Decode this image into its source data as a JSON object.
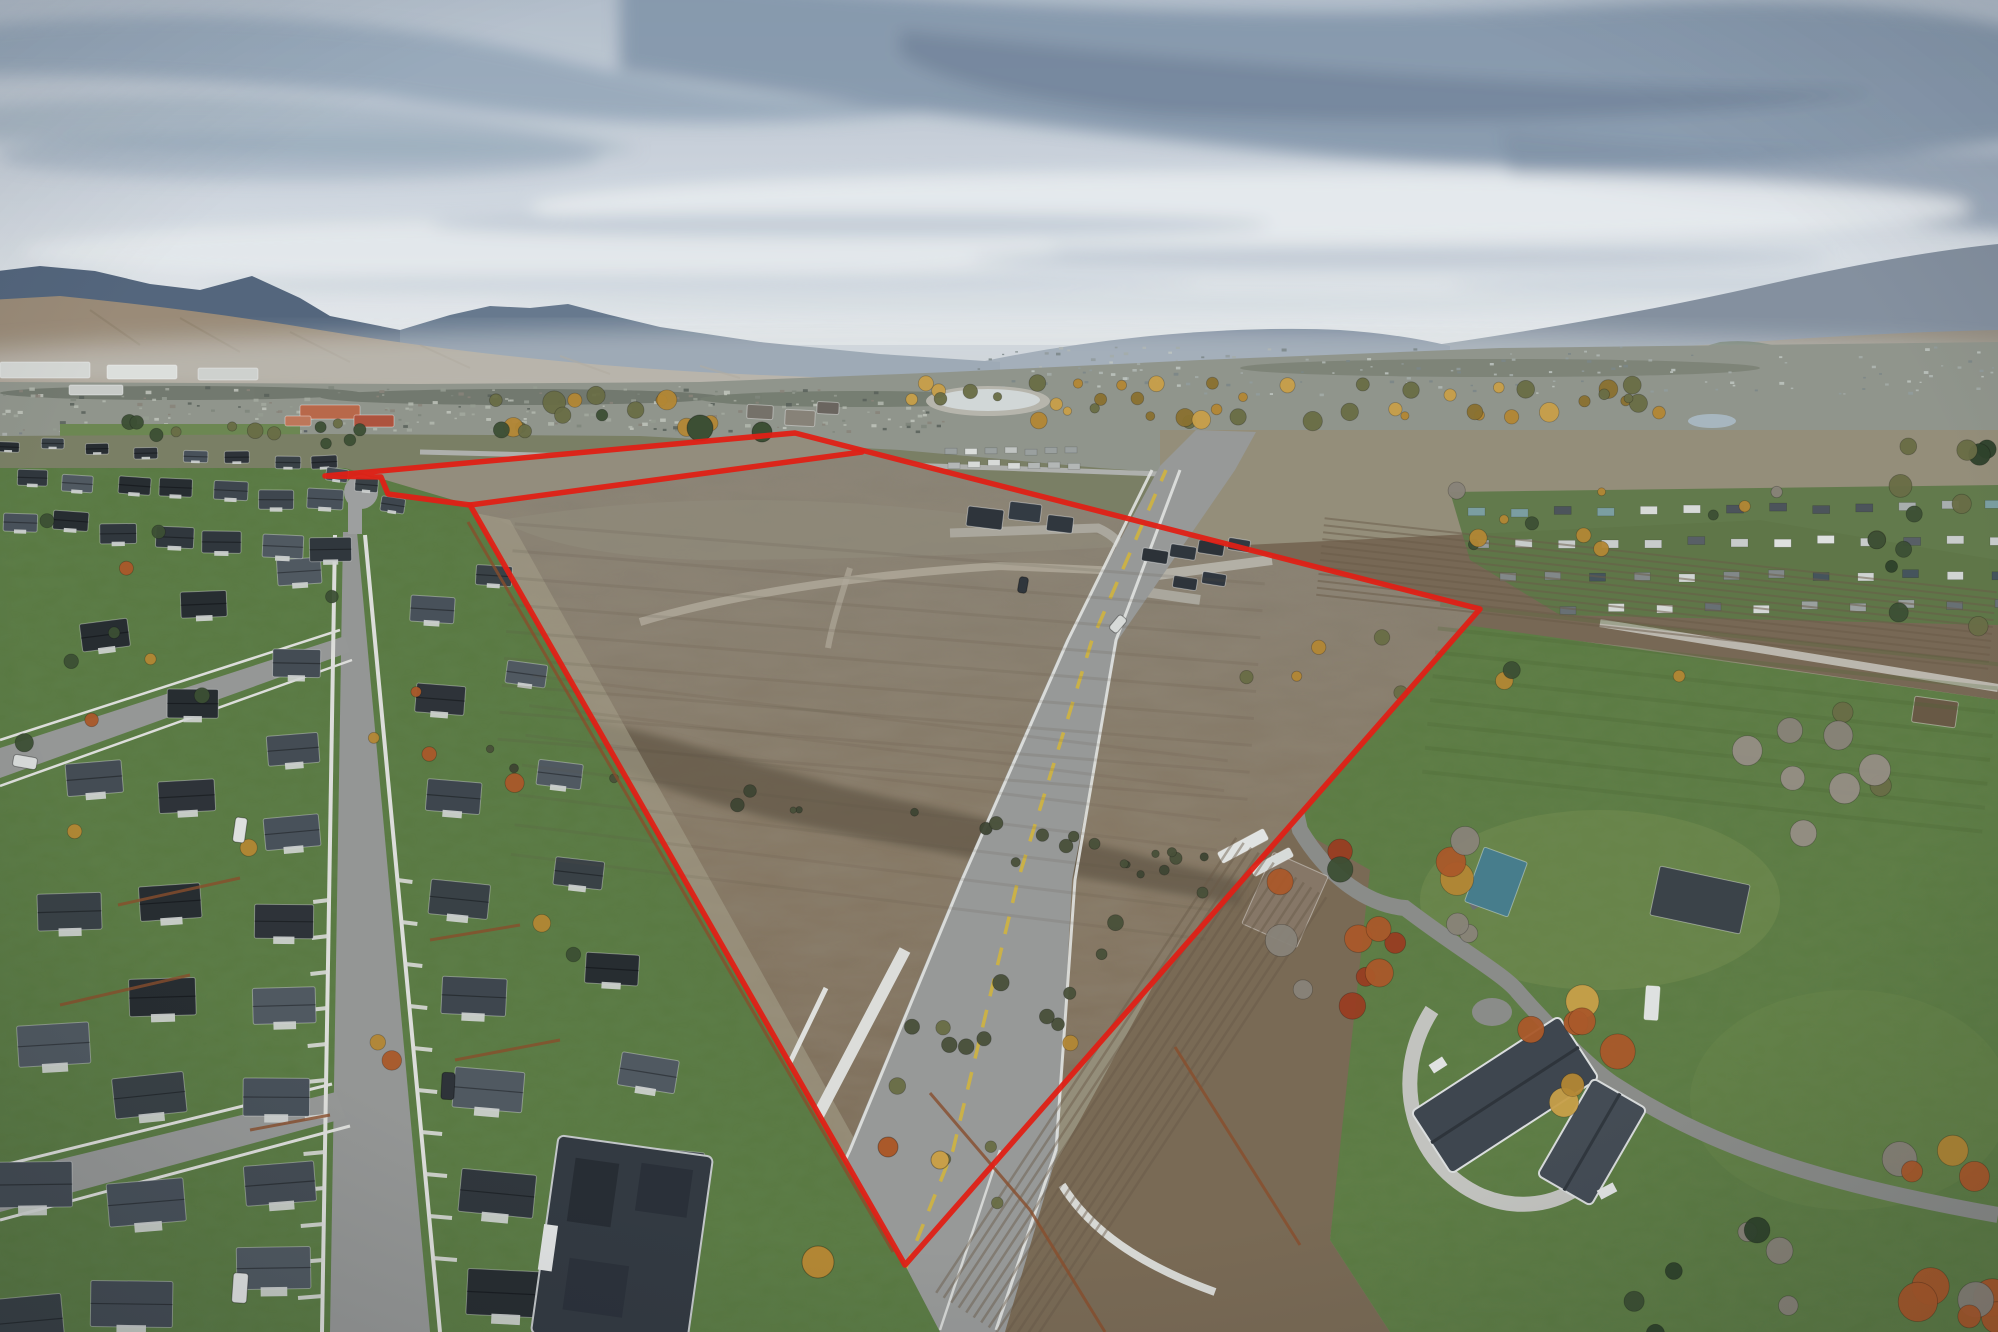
{
  "scene": {
    "description": "Aerial drone photo of a large vacant development parcel outlined in red, between a dense suburban subdivision on the left and large-lot rural homes on the right, with a city, river trees, foothills and cloudy sky in the distance.",
    "width": 1998,
    "height": 1332
  },
  "boundary": {
    "color": "#e81f13",
    "stroke_width": 5.5,
    "outer": "325,476 795,433 1480,609 905,1265 470,505 388,494 381,477",
    "strip_inner": "470,505 862,452"
  },
  "palette": {
    "sky_top": "#b9c4d0",
    "sky_horizon": "#eef1f3",
    "mountain_left": "#56687f",
    "mountain_mid": "#6a7c91",
    "mountain_right": "#8894a3",
    "foothill": "#a3917a",
    "city_base": "#95998f",
    "pasture": "#7e8266",
    "dry_field": "#99927c",
    "dirt_top": "#8d8577",
    "dirt_mid": "#897a64",
    "dirt_bottom": "#7c6b54",
    "dirt_strip": "#98917f",
    "ditch": "#675c49",
    "plow": "#7b6a55",
    "lawn": "#5a7c40",
    "lawn_bright": "#5e7e41",
    "asphalt": "#9c9d9b",
    "road_light": "#b4b0a6",
    "sidewalk": "#e4e4e0",
    "roof_dark": "#30353b",
    "wall_light": "#d8dad8",
    "fence_rust": "#8d4f2b",
    "tree_gold": "#b98a33",
    "tree_orange": "#b05a28",
    "tree_green": "#3d5033",
    "water_pale": "#dfe3e2",
    "center_line_yellow": "#d8b93f"
  },
  "generated": {
    "roof_colors": [
      "#2e3338",
      "#3a4146",
      "#454d54",
      "#525a62",
      "#31373c",
      "#3f474e",
      "#272c30",
      "#4a525a"
    ],
    "house_rows": [
      {
        "p1": [
          300,
          572
        ],
        "p2": [
          275,
          1270
        ],
        "n": 9,
        "w": [
          44,
          74
        ],
        "h": [
          26,
          42
        ],
        "rot": -2
      },
      {
        "p1": [
          205,
          600
        ],
        "p2": [
          135,
          1300
        ],
        "n": 8,
        "w": [
          46,
          82
        ],
        "h": [
          26,
          46
        ],
        "rot": -3
      },
      {
        "p1": [
          108,
          640
        ],
        "p2": [
          20,
          1320
        ],
        "n": 6,
        "w": [
          48,
          88
        ],
        "h": [
          28,
          50
        ],
        "rot": -4
      },
      {
        "p1": [
          430,
          606
        ],
        "p2": [
          505,
          1290
        ],
        "n": 8,
        "w": [
          44,
          80
        ],
        "h": [
          26,
          46
        ],
        "rot": 3
      },
      {
        "p1": [
          495,
          580
        ],
        "p2": [
          672,
          1170
        ],
        "n": 7,
        "w": [
          36,
          62
        ],
        "h": [
          20,
          36
        ],
        "rot": 6
      },
      {
        "p1": [
          35,
          476
        ],
        "p2": [
          322,
          502
        ],
        "n": 7,
        "w": [
          30,
          36
        ],
        "h": [
          16,
          20
        ],
        "rot": 2
      },
      {
        "p1": [
          18,
          520
        ],
        "p2": [
          330,
          548
        ],
        "n": 7,
        "w": [
          34,
          42
        ],
        "h": [
          18,
          24
        ],
        "rot": 2
      },
      {
        "p1": [
          5,
          444
        ],
        "p2": [
          330,
          464
        ],
        "n": 8,
        "w": [
          22,
          26
        ],
        "h": [
          10,
          13
        ],
        "rot": 1
      },
      {
        "p1": [
          338,
          478
        ],
        "p2": [
          398,
          500
        ],
        "n": 3,
        "w": [
          22,
          24
        ],
        "h": [
          13,
          15
        ],
        "rot": 8
      }
    ],
    "trailer_rows": [
      {
        "p1": [
          945,
          448
        ],
        "p2": [
          1065,
          448
        ],
        "n": 7,
        "w": 12,
        "h": 6,
        "colors": [
          "#e2e4e1",
          "#c7cac7",
          "#9fa5a3"
        ]
      },
      {
        "p1": [
          948,
          461
        ],
        "p2": [
          1068,
          462
        ],
        "n": 7,
        "w": 12,
        "h": 6,
        "colors": [
          "#dfe1de",
          "#b9bdba"
        ]
      },
      {
        "p1": [
          1468,
          508
        ],
        "p2": [
          1985,
          502
        ],
        "n": 13,
        "w": 17,
        "h": 8,
        "colors": [
          "#dfe1de",
          "#aeb3b2",
          "#7fa3a5",
          "#4e555b"
        ]
      },
      {
        "p1": [
          1472,
          540
        ],
        "p2": [
          1990,
          536
        ],
        "n": 13,
        "w": 17,
        "h": 8,
        "colors": [
          "#e6e8e5",
          "#9aa09e",
          "#5a6167",
          "#cfd3d0"
        ]
      },
      {
        "p1": [
          1500,
          574
        ],
        "p2": [
          1992,
          570
        ],
        "n": 12,
        "w": 16,
        "h": 8,
        "colors": [
          "#d8dbd8",
          "#868c8b",
          "#47555c"
        ]
      },
      {
        "p1": [
          1560,
          606
        ],
        "p2": [
          1995,
          600
        ],
        "n": 10,
        "w": 16,
        "h": 8,
        "colors": [
          "#dcdedb",
          "#9fa5a3",
          "#6b7276"
        ]
      }
    ],
    "rural_buildings": [
      {
        "x": 1285,
        "y": 900,
        "w": 60,
        "h": 78,
        "rot": 24,
        "roof": "#8a7a68"
      },
      {
        "x": 1496,
        "y": 882,
        "w": 46,
        "h": 58,
        "rot": 20,
        "roof": "#49808f"
      },
      {
        "x": 1700,
        "y": 900,
        "w": 92,
        "h": 50,
        "rot": 12,
        "roof": "#3c4349"
      },
      {
        "x": 1935,
        "y": 712,
        "w": 44,
        "h": 26,
        "rot": 8,
        "roof": "#6b5a44"
      },
      {
        "x": 1652,
        "y": 1003,
        "w": 14,
        "h": 34,
        "rot": 4,
        "roof": "#e6e8e6"
      },
      {
        "x": 985,
        "y": 518,
        "w": 36,
        "h": 20,
        "rot": 7,
        "roof": "#2e343a"
      },
      {
        "x": 1025,
        "y": 512,
        "w": 32,
        "h": 18,
        "rot": 7,
        "roof": "#343b42"
      },
      {
        "x": 1060,
        "y": 524,
        "w": 26,
        "h": 16,
        "rot": 7,
        "roof": "#31373d"
      },
      {
        "x": 1155,
        "y": 556,
        "w": 26,
        "h": 13,
        "rot": 9,
        "roof": "#2c3237"
      },
      {
        "x": 1183,
        "y": 552,
        "w": 26,
        "h": 13,
        "rot": 9,
        "roof": "#30363c"
      },
      {
        "x": 1211,
        "y": 548,
        "w": 26,
        "h": 13,
        "rot": 9,
        "roof": "#2c3237"
      },
      {
        "x": 1239,
        "y": 545,
        "w": 22,
        "h": 12,
        "rot": 9,
        "roof": "#333940"
      },
      {
        "x": 1185,
        "y": 583,
        "w": 24,
        "h": 12,
        "rot": 9,
        "roof": "#2e343a"
      },
      {
        "x": 1214,
        "y": 579,
        "w": 24,
        "h": 12,
        "rot": 9,
        "roof": "#31373e"
      },
      {
        "x": 760,
        "y": 412,
        "w": 26,
        "h": 14,
        "rot": 3,
        "roof": "#79736a"
      },
      {
        "x": 800,
        "y": 418,
        "w": 30,
        "h": 16,
        "rot": 3,
        "roof": "#8b857a"
      },
      {
        "x": 828,
        "y": 408,
        "w": 22,
        "h": 12,
        "rot": 3,
        "roof": "#6d6760"
      },
      {
        "x": 1243,
        "y": 846,
        "w": 52,
        "h": 12,
        "rot": -28,
        "roof": "#e9ebe8"
      },
      {
        "x": 1272,
        "y": 862,
        "w": 44,
        "h": 10,
        "rot": -28,
        "roof": "#dfe2df"
      },
      {
        "x": 330,
        "y": 412,
        "w": 60,
        "h": 14,
        "rot": 0,
        "roof": "#bf6a4a"
      },
      {
        "x": 374,
        "y": 421,
        "w": 40,
        "h": 12,
        "rot": 0,
        "roof": "#b3543d"
      },
      {
        "x": 298,
        "y": 421,
        "w": 26,
        "h": 10,
        "rot": 0,
        "roof": "#c47a5a"
      },
      {
        "x": 45,
        "y": 370,
        "w": 90,
        "h": 16,
        "rot": 0,
        "roof": "#dcdeda"
      },
      {
        "x": 142,
        "y": 372,
        "w": 70,
        "h": 14,
        "rot": 0,
        "roof": "#e4e6e2"
      },
      {
        "x": 228,
        "y": 374,
        "w": 60,
        "h": 12,
        "rot": 0,
        "roof": "#d6d8d4"
      },
      {
        "x": 96,
        "y": 390,
        "w": 54,
        "h": 10,
        "rot": 0,
        "roof": "#cfd1cd"
      }
    ],
    "tree_clusters": [
      {
        "cx": 1280,
        "cy": 402,
        "sx": 390,
        "sy": 20,
        "n": 46,
        "rmin": 4,
        "rmax": 10,
        "colors": [
          "#b98a33",
          "#cfa449",
          "#6c6f45",
          "#8f742f"
        ]
      },
      {
        "cx": 640,
        "cy": 414,
        "sx": 150,
        "sy": 20,
        "n": 15,
        "rmin": 5,
        "rmax": 12,
        "colors": [
          "#3d5033",
          "#6c6f45",
          "#b98a33"
        ]
      },
      {
        "cx": 240,
        "cy": 432,
        "sx": 120,
        "sy": 12,
        "n": 12,
        "rmin": 4,
        "rmax": 8,
        "colors": [
          "#3d5033",
          "#6c6f45"
        ]
      },
      {
        "cx": 1930,
        "cy": 540,
        "sx": 60,
        "sy": 95,
        "n": 13,
        "rmin": 6,
        "rmax": 12,
        "colors": [
          "#2f4229",
          "#3d5033",
          "#6c6f45"
        ]
      },
      {
        "cx": 1610,
        "cy": 525,
        "sx": 170,
        "sy": 40,
        "n": 11,
        "rmin": 4,
        "rmax": 9,
        "colors": [
          "#b98a33",
          "#6c6f45",
          "#3d5033",
          "#8d867b"
        ]
      },
      {
        "cx": 1365,
        "cy": 925,
        "sx": 105,
        "sy": 85,
        "n": 16,
        "rmin": 8,
        "rmax": 17,
        "colors": [
          "#b05a28",
          "#b98a33",
          "#3d5033",
          "#8d867b",
          "#9e3d20"
        ]
      },
      {
        "cx": 1568,
        "cy": 1048,
        "sx": 55,
        "sy": 55,
        "n": 7,
        "rmin": 11,
        "rmax": 20,
        "colors": [
          "#b98a33",
          "#b05a28",
          "#cfa449"
        ]
      },
      {
        "cx": 1822,
        "cy": 785,
        "sx": 80,
        "sy": 90,
        "n": 9,
        "rmin": 10,
        "rmax": 18,
        "colors": [
          "#8d867b",
          "#9a9287",
          "#6c6f45"
        ]
      },
      {
        "cx": 1938,
        "cy": 1235,
        "sx": 65,
        "sy": 110,
        "n": 10,
        "rmin": 10,
        "rmax": 20,
        "colors": [
          "#b98a33",
          "#b05a28",
          "#8d867b"
        ]
      },
      {
        "cx": 1705,
        "cy": 1285,
        "sx": 120,
        "sy": 55,
        "n": 7,
        "rmin": 8,
        "rmax": 14,
        "colors": [
          "#2f4229",
          "#8d867b",
          "#3d5033"
        ]
      },
      {
        "cx": 860,
        "cy": 818,
        "sx": 380,
        "sy": 22,
        "n": 22,
        "rmin": 3,
        "rmax": 7,
        "colors": [
          "#4a5138",
          "#3f4632"
        ],
        "slope": 0.17
      },
      {
        "cx": 950,
        "cy": 1085,
        "sx": 55,
        "sy": 140,
        "n": 10,
        "rmin": 4,
        "rmax": 9,
        "colors": [
          "#4a5138",
          "#6c6f45"
        ]
      },
      {
        "cx": 1085,
        "cy": 955,
        "sx": 40,
        "sy": 120,
        "n": 8,
        "rmin": 4,
        "rmax": 8,
        "colors": [
          "#4a5138",
          "#b98a33"
        ]
      },
      {
        "cx": 185,
        "cy": 705,
        "sx": 165,
        "sy": 210,
        "n": 12,
        "rmin": 5,
        "rmax": 10,
        "colors": [
          "#b98a33",
          "#b05a28",
          "#3d5033"
        ]
      },
      {
        "cx": 470,
        "cy": 905,
        "sx": 115,
        "sy": 255,
        "n": 8,
        "rmin": 5,
        "rmax": 10,
        "colors": [
          "#b98a33",
          "#3d5033",
          "#b05a28"
        ]
      },
      {
        "cx": 1475,
        "cy": 662,
        "sx": 260,
        "sy": 35,
        "n": 8,
        "rmin": 5,
        "rmax": 9,
        "colors": [
          "#6c6f45",
          "#3d5033",
          "#b98a33"
        ]
      }
    ],
    "big_trees": [
      {
        "x": 818,
        "y": 1262,
        "r": 16,
        "c": "#b98a33"
      },
      {
        "x": 888,
        "y": 1147,
        "r": 10,
        "c": "#b05a28"
      },
      {
        "x": 940,
        "y": 1160,
        "r": 9,
        "c": "#cfa449"
      },
      {
        "x": 700,
        "y": 428,
        "r": 13,
        "c": "#3d5033"
      },
      {
        "x": 762,
        "y": 432,
        "r": 10,
        "c": "#3d5033"
      }
    ],
    "furrow_groups": [
      {
        "p1": [
          1320,
          560
        ],
        "p2": [
          1992,
          634
        ],
        "n": 12,
        "gap": 7,
        "c": "#6d5d49",
        "o": 0.5,
        "w": 2
      },
      {
        "p1": [
          985,
          1325
        ],
        "p2": [
          1285,
          870
        ],
        "n": 13,
        "gap": 9,
        "c": "#6d5c48",
        "o": 0.45,
        "w": 2.5
      },
      {
        "p1": [
          505,
          645
        ],
        "p2": [
          1255,
          705
        ],
        "n": 9,
        "gap": 27,
        "c": "#5e5444",
        "o": 0.14,
        "w": 3
      },
      {
        "p1": [
          520,
          780
        ],
        "p2": [
          1215,
          865
        ],
        "n": 7,
        "gap": 30,
        "c": "#5e5444",
        "o": 0.12,
        "w": 3
      },
      {
        "p1": [
          1430,
          700
        ],
        "p2": [
          1990,
          760
        ],
        "n": 8,
        "gap": 24,
        "c": "#4c6a33",
        "o": 0.25,
        "w": 4
      }
    ],
    "speck_bands": [
      {
        "x": 0,
        "y": 386,
        "w": 950,
        "h": 46,
        "n": 240,
        "smin": 2,
        "smax": 6,
        "colors": [
          "#83887e",
          "#9aa094",
          "#c7cabf",
          "#5c635c",
          "#a9aea2",
          "#8d867b",
          "#b9bdb3"
        ]
      },
      {
        "x": 950,
        "y": 346,
        "w": 1048,
        "h": 48,
        "n": 150,
        "smin": 2,
        "smax": 5,
        "colors": [
          "#97a0a0",
          "#aab2ad",
          "#c5cbc6",
          "#7f8a89",
          "#b7bdb8"
        ]
      },
      {
        "x": 0,
        "y": 430,
        "w": 340,
        "h": 38,
        "n": 70,
        "smin": 3,
        "smax": 8,
        "colors": [
          "#4a5056",
          "#6a7076",
          "#b5b9b5",
          "#7e8487",
          "#565c62"
        ]
      },
      {
        "x": 1230,
        "y": 430,
        "w": 560,
        "h": 44,
        "n": 70,
        "smin": 2,
        "smax": 6,
        "colors": [
          "#9a9f93",
          "#b5b9ae",
          "#6f7570",
          "#c8cbc1"
        ]
      }
    ],
    "fences_rust": [
      [
        [
          468,
          522
        ],
        [
          893,
          1252
        ]
      ],
      [
        [
          930,
          1093
        ],
        [
          1030,
          1210
        ]
      ],
      [
        [
          1030,
          1210
        ],
        [
          1105,
          1332
        ]
      ],
      [
        [
          1175,
          1047
        ],
        [
          1300,
          1245
        ]
      ],
      [
        [
          118,
          905
        ],
        [
          240,
          878
        ]
      ],
      [
        [
          60,
          1005
        ],
        [
          190,
          975
        ]
      ],
      [
        [
          250,
          1130
        ],
        [
          330,
          1115
        ]
      ],
      [
        [
          430,
          940
        ],
        [
          520,
          925
        ]
      ],
      [
        [
          455,
          1060
        ],
        [
          560,
          1040
        ]
      ]
    ],
    "cars": [
      {
        "x": 240,
        "y": 1288,
        "w": 15,
        "h": 30,
        "rot": 4,
        "c": "#e9eae8"
      },
      {
        "x": 448,
        "y": 1086,
        "w": 13,
        "h": 27,
        "rot": 3,
        "c": "#2e3338"
      },
      {
        "x": 25,
        "y": 762,
        "w": 12,
        "h": 24,
        "rot": 100,
        "c": "#dfe1df"
      },
      {
        "x": 240,
        "y": 830,
        "w": 12,
        "h": 25,
        "rot": 8,
        "c": "#e6e7e5"
      },
      {
        "x": 1118,
        "y": 624,
        "w": 10,
        "h": 18,
        "rot": 40,
        "c": "#dfe1de"
      },
      {
        "x": 1023,
        "y": 585,
        "w": 9,
        "h": 16,
        "rot": 10,
        "c": "#31363b"
      }
    ]
  }
}
